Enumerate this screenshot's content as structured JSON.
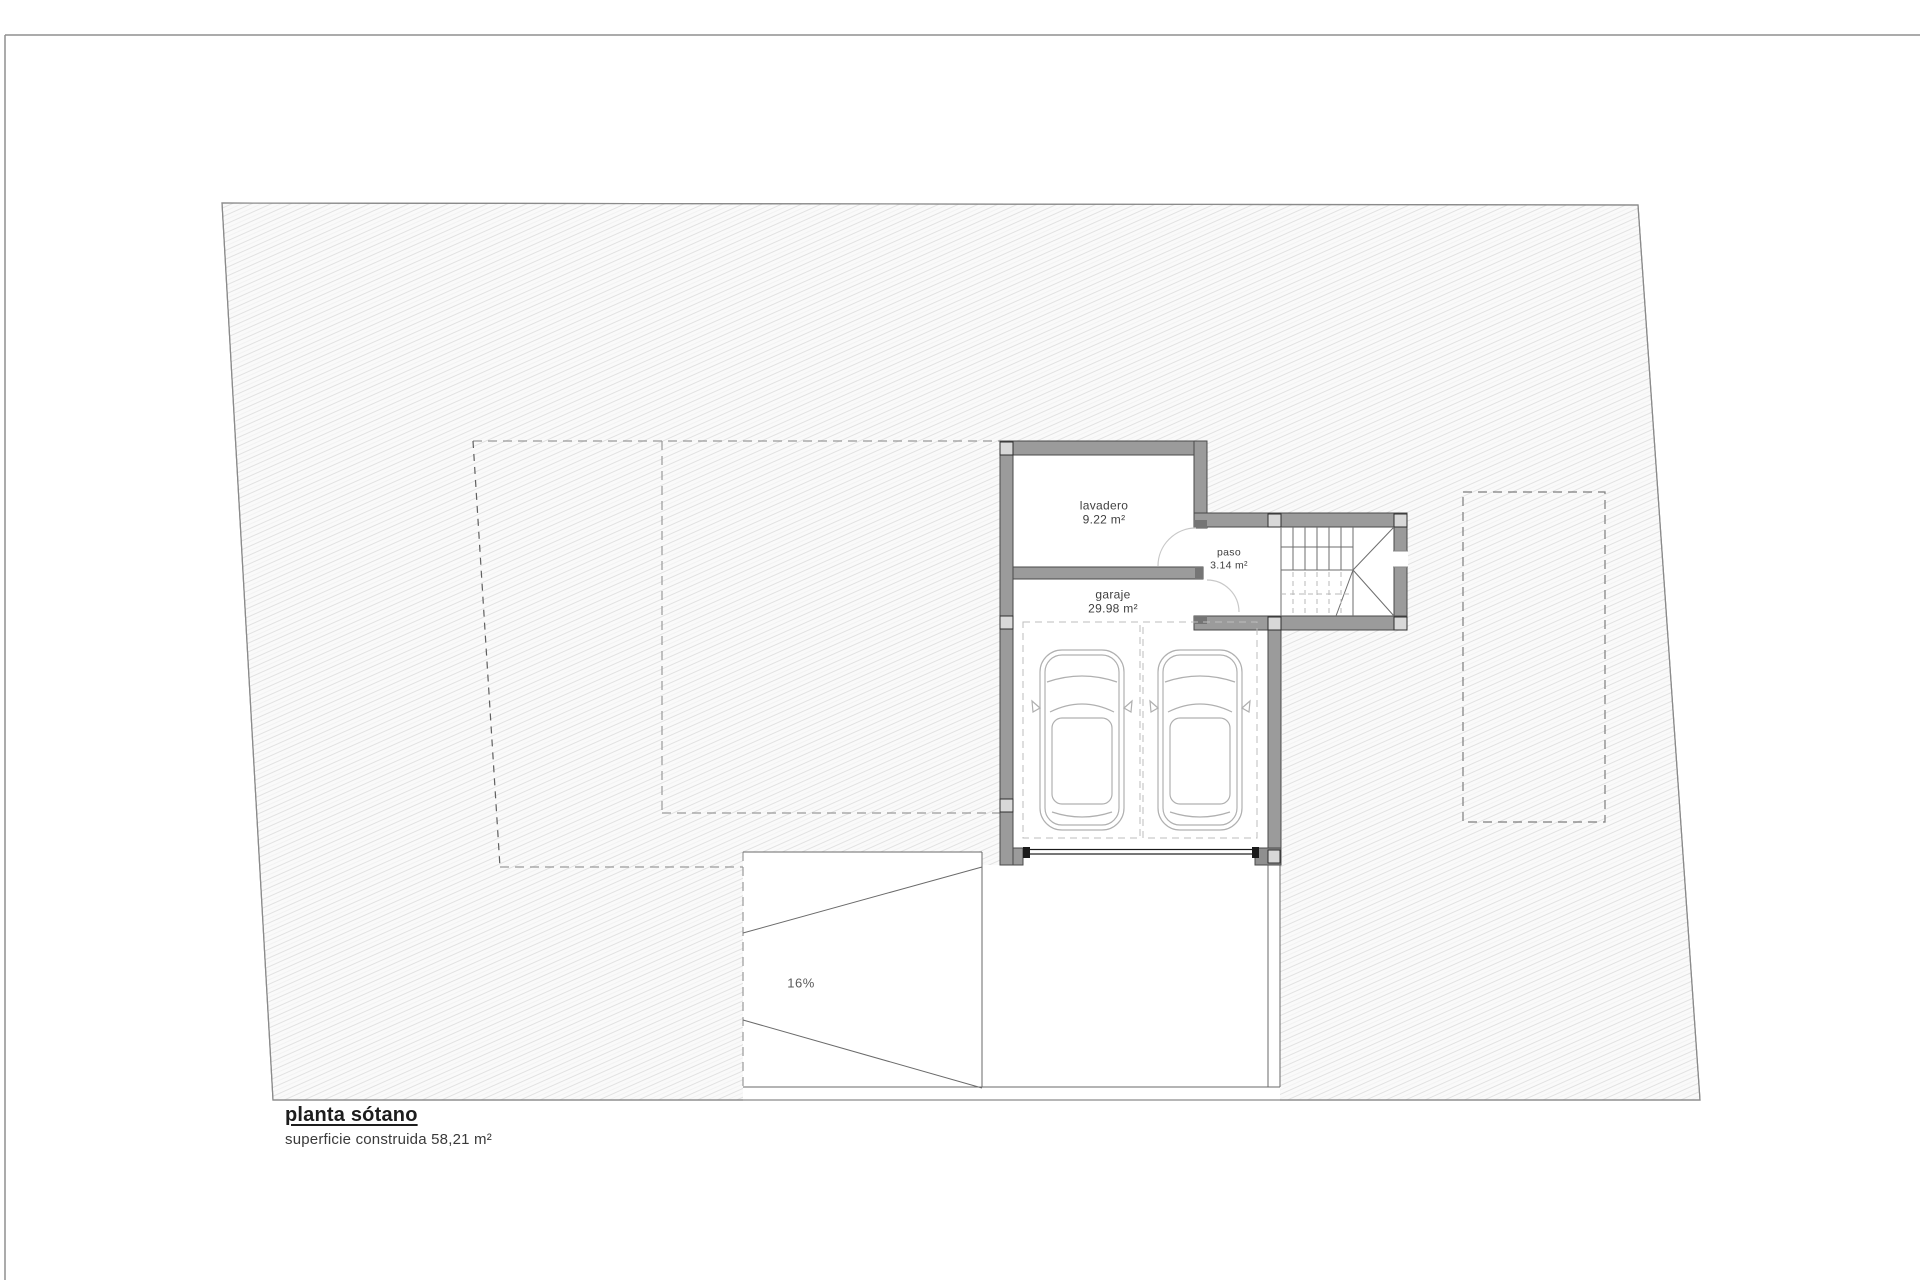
{
  "plan": {
    "title": "planta sótano",
    "area_note": "superficie construida 58,21 m²",
    "rooms": {
      "lavadero": {
        "name": "lavadero",
        "area": "9.22 m²"
      },
      "paso": {
        "name": "paso",
        "area": "3.14 m²"
      },
      "garaje": {
        "name": "garaje",
        "area": "29.98 m²"
      }
    },
    "ramp": {
      "slope_label": "16%"
    },
    "colors": {
      "paper": "#ffffff",
      "wall_fill": "#9b9b9b",
      "wall_edge": "#4a4a4a",
      "pillar_fill": "#d8d8d8",
      "hatch_line": "#e2e2e2",
      "boundary_line": "#8a8a8a",
      "door_line": "#1a1a1a",
      "light_line": "#bdbdbd"
    }
  }
}
